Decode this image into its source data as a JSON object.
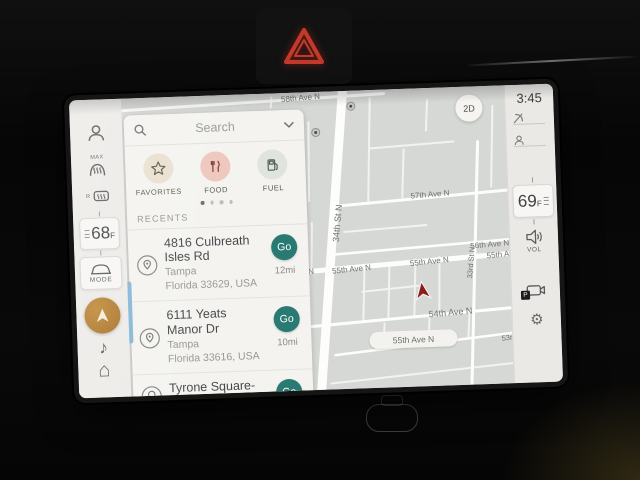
{
  "screen": {
    "sidebar": {
      "defrost_front_label": "MAX",
      "defrost_rear_label": "R",
      "driver_temp": "68",
      "driver_temp_unit": "F",
      "mode_label": "MODE"
    },
    "search_panel": {
      "search_placeholder": "Search",
      "categories": [
        {
          "label": "FAVORITES"
        },
        {
          "label": "FOOD"
        },
        {
          "label": "FUEL"
        }
      ],
      "recents_header": "RECENTS",
      "recents": [
        {
          "title": "4816 Culbreath Isles Rd",
          "city": "Tampa",
          "region": "Florida 33629, USA",
          "go_label": "Go",
          "distance": "12mi"
        },
        {
          "title": "6111 Yeats Manor Dr",
          "city": "Tampa",
          "region": "Florida 33616, USA",
          "go_label": "Go",
          "distance": "10mi"
        },
        {
          "title": "Tyrone Square-South",
          "go_label": "Go"
        }
      ]
    },
    "map": {
      "view_toggle": "2D",
      "labels": {
        "ave58": "58th Ave N",
        "ave57": "57th Ave N",
        "ave56": "56th Ave N",
        "ave55_left": "55th Ave N",
        "ave55_a": "55th Ave N",
        "ave55_b": "55th Ave N",
        "ave55_c": "55th Ave N",
        "ave54": "54th Ave N",
        "st34": "34th St N",
        "st33": "33rd St N",
        "ter53": "53rd Ter",
        "pill": "55th Ave N"
      }
    },
    "right_bar": {
      "time": "3:45",
      "passenger_temp": "69",
      "passenger_temp_unit": "F",
      "volume_label": "VOL",
      "camera_badge": "P"
    }
  },
  "icons": {
    "music_note": "♪",
    "home": "⌂",
    "gear": "⚙"
  },
  "colors": {
    "teal_go": "#2a7a74",
    "nav_orange": "#a66f24",
    "map_bg": "#d6d8d5",
    "hazard_red": "#c33a2c",
    "position_arrow_red": "#8e1c1c",
    "scroll_blue": "#85b6d6",
    "favorites_circle": "#e9e0cf",
    "food_circle": "#eec7bd",
    "fuel_circle": "#e0e4df"
  }
}
